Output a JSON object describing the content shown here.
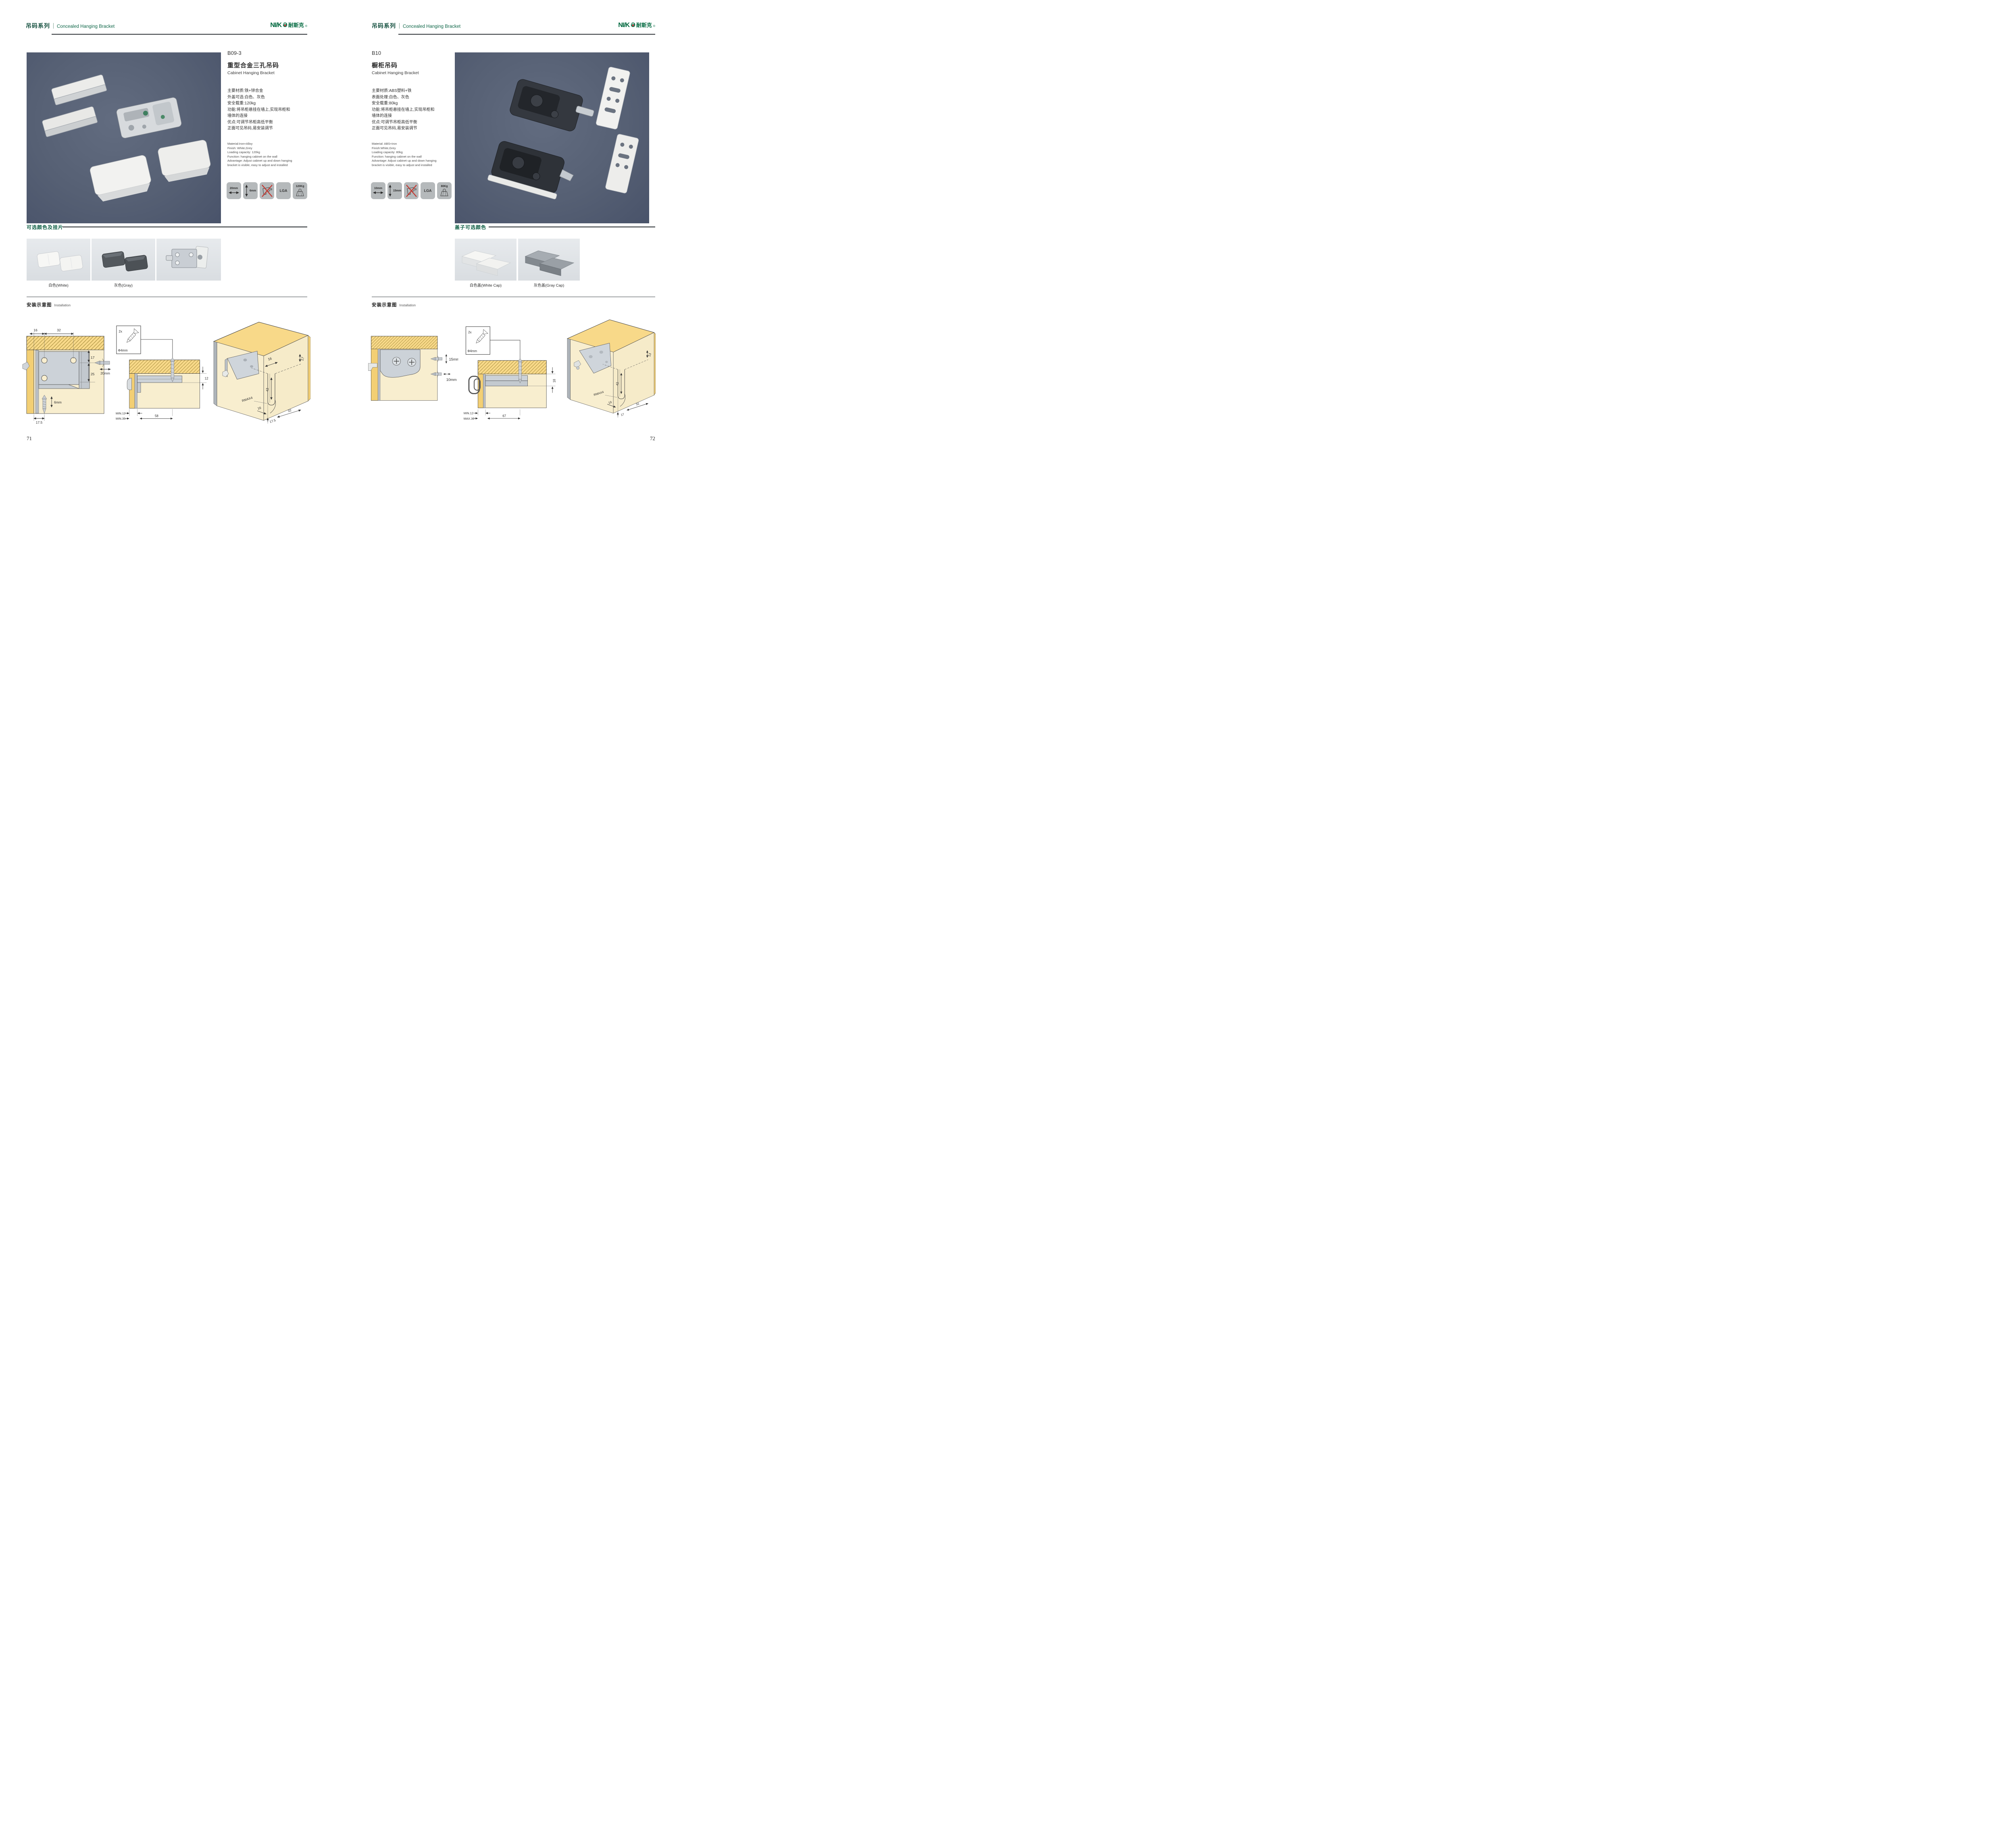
{
  "header": {
    "series_cn": "吊码系列",
    "series_en": "Concealed Hanging Bracket",
    "logo_en": "NI/K",
    "logo_e": "Ə",
    "logo_cn": "耐斯克",
    "logo_reg": "®"
  },
  "sections": {
    "install_cn": "安装示意图",
    "install_en": "Installation"
  },
  "colors": {
    "accent_green": "#0f5f45",
    "photo_bg": "#566074",
    "badge_bg": "#b5b9bb",
    "wood_yellow": "#f8d989",
    "wood_cream": "#f8eecf",
    "no_icon_red": "#c23b34"
  },
  "pages": [
    {
      "code": "B09-3",
      "title_cn": "重型合金三孔吊码",
      "title_en": "Cabinet Hanging Bracket",
      "specs_cn": "主要材质:铁+锌合金\n外盖可选:白色、灰色\n安全载重:120kg\n功能:将吊柜悬挂在墙上,实现吊柜和\n墙体的连接\n优点:可调节吊柜高低平衡\n正面可见吊码,易安装调节",
      "specs_en": "Material:Iron+Alloy\nFinish: White,Grey\nLoading capacity: 120kg\nFunction: hanging cabinet on the wall\nAdvantage: Adjust cabinet up and down hanging\nbracket is visible, easy to adjust and installed",
      "badges": [
        {
          "icon": "horizontal-arrow-icon",
          "label": "20mm"
        },
        {
          "icon": "vertical-arrow-icon",
          "label": "6mm"
        },
        {
          "icon": "no-drill-icon",
          "label": ""
        },
        {
          "icon": "lga-cert",
          "label": "LGA"
        },
        {
          "icon": "weight-icon",
          "label": "120Kg"
        }
      ],
      "colors_title": "可选颜色及挂片",
      "swatches": [
        "白色(White)",
        "灰色(Gray)",
        ""
      ],
      "d1": {
        "dims": [
          "16",
          "32",
          "17",
          "25",
          "20mm",
          "6mm",
          "17.5"
        ]
      },
      "d2": {
        "dims": [
          "2x",
          "Φ4mm",
          "12",
          "MIN.12",
          "MIN.35",
          "58"
        ]
      },
      "d3": {
        "dims": [
          "16",
          "17",
          "42",
          "RMAX4",
          "16",
          "17.5",
          "32"
        ]
      },
      "page_number": "71"
    },
    {
      "code": "B10",
      "title_cn": "橱柜吊码",
      "title_en": "Cabinet Hanging Bracket",
      "specs_cn": "主要材质:ABS塑料+铁\n表面处理:白色、灰色\n安全载重:80kg\n功能:将吊柜悬挂在墙上,实现吊柜和\n墙体的连接\n优点:可调节吊柜高低平衡\n正面可见吊码,易安装调节",
      "specs_en": "Material: ABS+iron\nFinish:White,Grey\nLoading capacity: 80kg\nFunction: hanging cabinet on the wall\nAdvantage: Adjust cabinet up and down hanging\nbracket is visible, easy to adjust and installed",
      "badges": [
        {
          "icon": "horizontal-arrow-icon",
          "label": "10mm"
        },
        {
          "icon": "vertical-arrow-icon",
          "label": "15mm"
        },
        {
          "icon": "no-drill-icon",
          "label": ""
        },
        {
          "icon": "lga-cert",
          "label": "LGA"
        },
        {
          "icon": "weight-icon",
          "label": "80Kg"
        }
      ],
      "colors_title": "盖子可选颜色",
      "swatches": [
        "白色盖(White Cap)",
        "灰色盖(Gray Cap)"
      ],
      "d1": {
        "dims": [
          "15mm",
          "10mm"
        ]
      },
      "d2": {
        "dims": [
          "2x",
          "Φ4mm",
          "18",
          "MIN.12",
          "MAX.30",
          "67"
        ]
      },
      "d3": {
        "dims": [
          "13",
          "42",
          "RMAX4",
          "19",
          "17",
          "32"
        ]
      },
      "page_number": "72"
    }
  ]
}
